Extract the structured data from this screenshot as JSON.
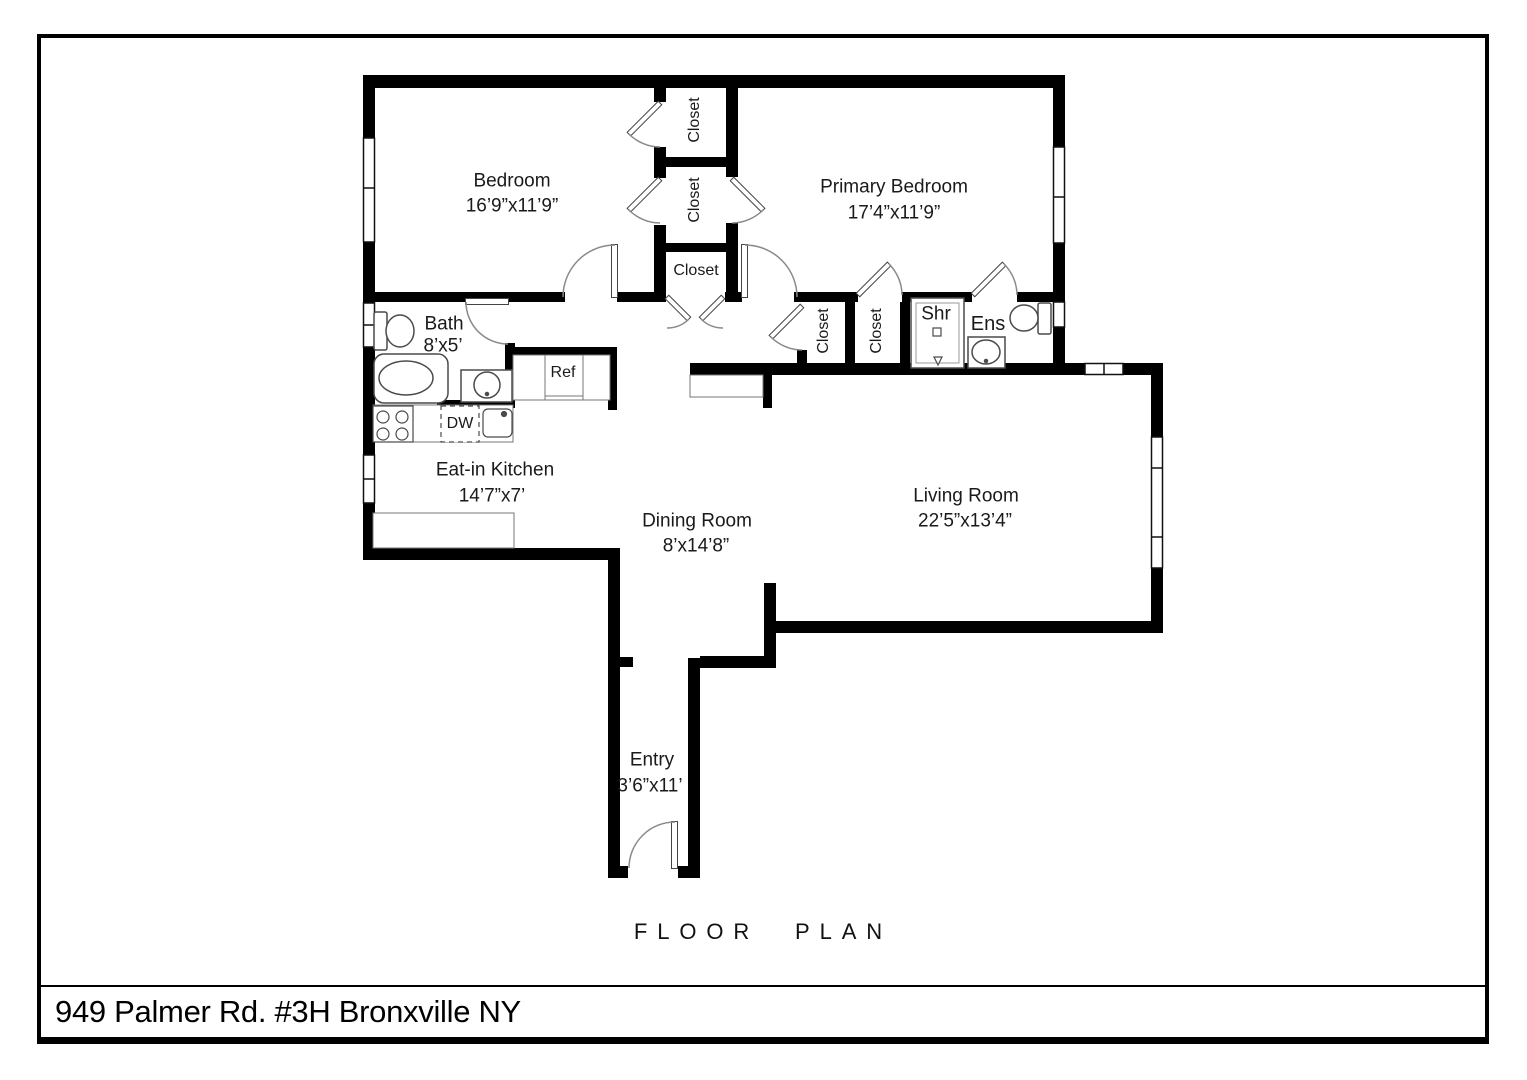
{
  "footer": {
    "caption": "FLOOR PLAN",
    "address": "949 Palmer Rd. #3H Bronxville NY"
  },
  "plan": {
    "rooms": [
      {
        "id": "bedroom",
        "name": "Bedroom",
        "dims": "16’9”x11’9”"
      },
      {
        "id": "primary_bedroom",
        "name": "Primary Bedroom",
        "dims": "17’4”x11’9”"
      },
      {
        "id": "bath",
        "name": "Bath",
        "dims": "8’x5’"
      },
      {
        "id": "eat_in_kitchen",
        "name": "Eat-in Kitchen",
        "dims": "14’7”x7’"
      },
      {
        "id": "dining_room",
        "name": "Dining Room",
        "dims": "8’x14’8”"
      },
      {
        "id": "living_room",
        "name": "Living Room",
        "dims": "22’5”x13’4”"
      },
      {
        "id": "entry",
        "name": "Entry",
        "dims": "3’6”x11’"
      }
    ],
    "closet_labels": [
      "Closet",
      "Closet",
      "Closet",
      "Closet",
      "Closet"
    ],
    "fixture_labels": {
      "shower": "Shr",
      "ensuite": "Ens",
      "refrigerator": "Ref",
      "dishwasher": "DW"
    },
    "colors": {
      "wall": "#000000",
      "background": "#ffffff",
      "fixture_outline": "#444444",
      "door_arc": "#8a8a8a"
    }
  }
}
